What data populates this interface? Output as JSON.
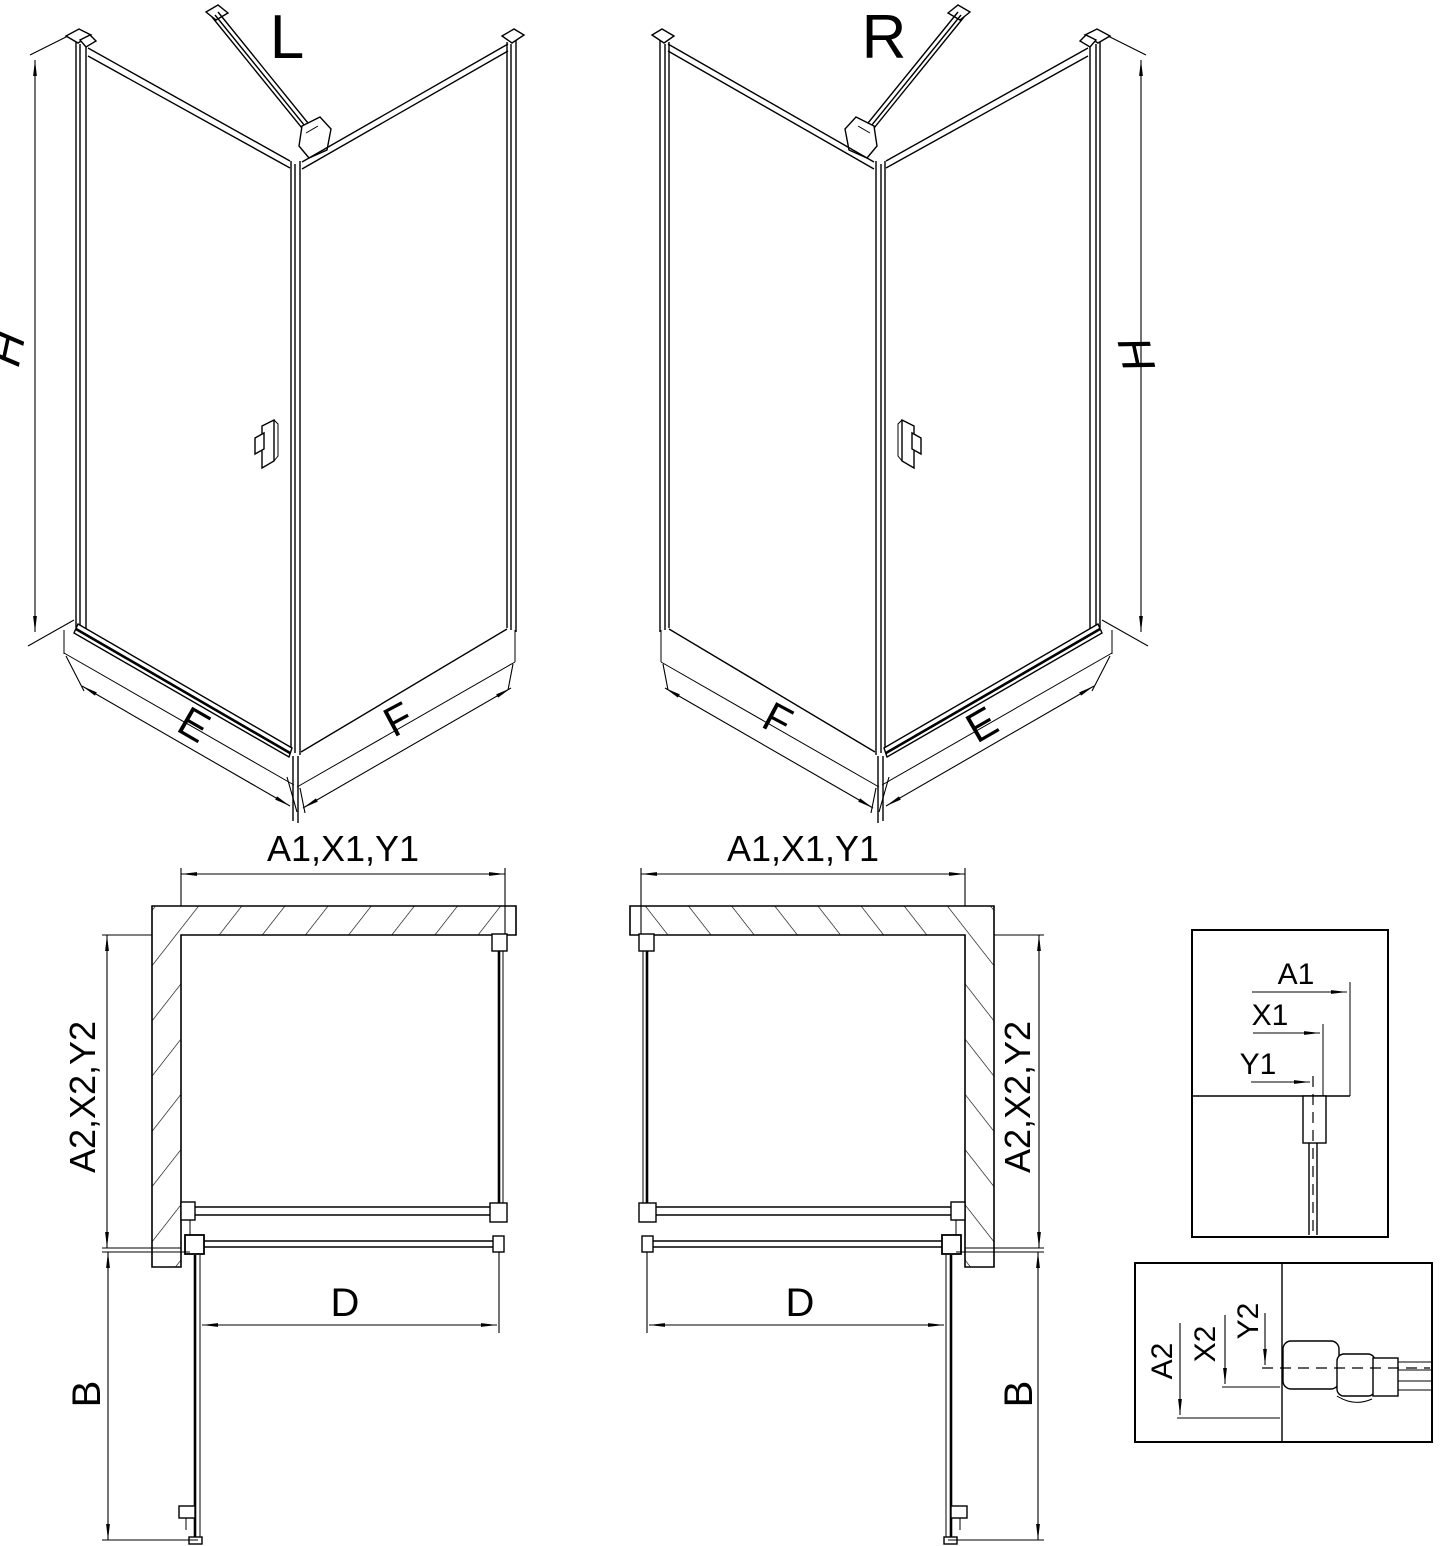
{
  "drawing": {
    "background": "#ffffff",
    "line_color": "#000000",
    "views": {
      "iso_left": {
        "variant_label": "L",
        "height_dim": "H",
        "door_side_dim": "E",
        "fixed_side_dim": "F"
      },
      "iso_right": {
        "variant_label": "R",
        "height_dim": "H",
        "door_side_dim": "E",
        "fixed_side_dim": "F"
      },
      "plan_left": {
        "top_dim": "A1,X1,Y1",
        "side_dim": "A2,X2,Y2",
        "door_width_dim": "D",
        "swing_dim": "B"
      },
      "plan_right": {
        "top_dim": "A1,X1,Y1",
        "side_dim": "A2,X2,Y2",
        "door_width_dim": "D",
        "swing_dim": "B"
      },
      "detail_top_profile": {
        "dims": [
          "A1",
          "X1",
          "Y1"
        ]
      },
      "detail_bottom_profile": {
        "dims": [
          "A2",
          "X2",
          "Y2"
        ]
      }
    }
  }
}
